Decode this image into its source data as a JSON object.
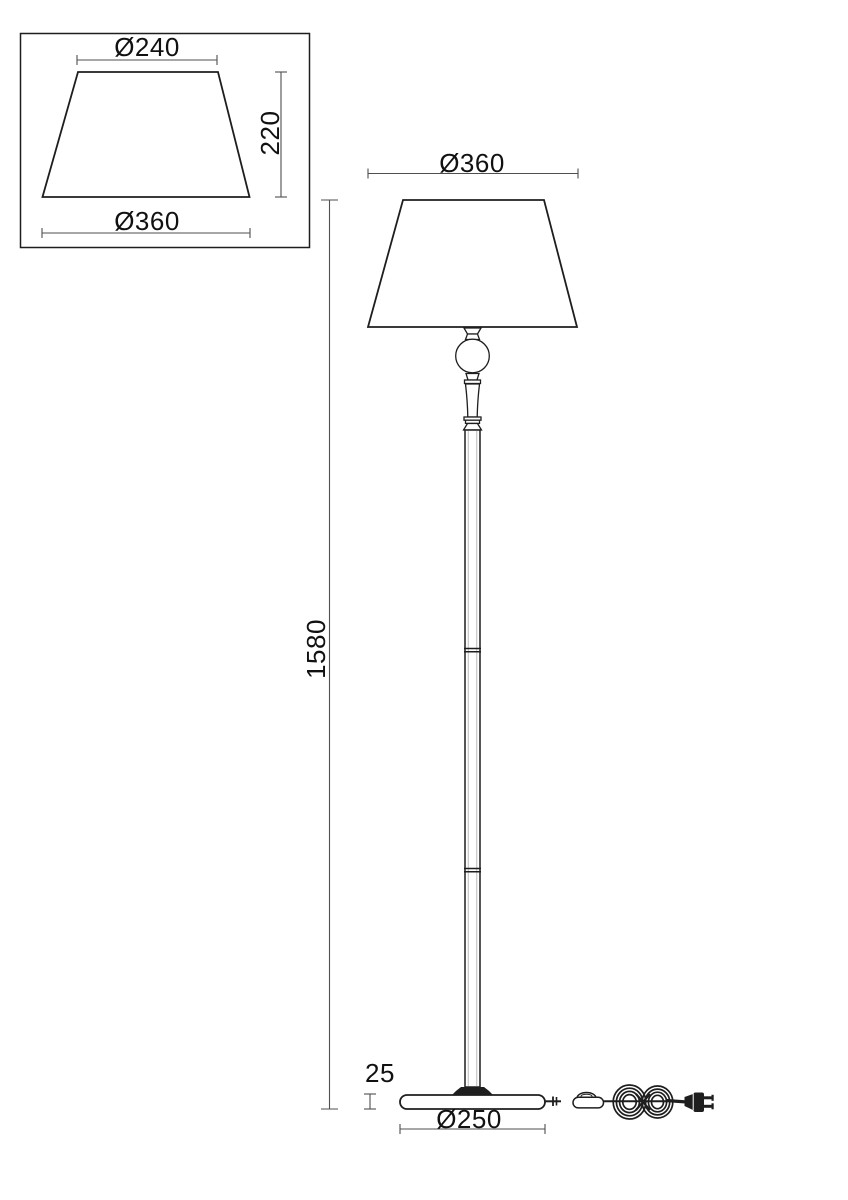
{
  "colors": {
    "background": "#ffffff",
    "line": "#1e1e1e",
    "dimension": "#4f4f4f",
    "text": "#111111"
  },
  "detail_view": {
    "top_diameter_label": "Ø240",
    "height_label": "220",
    "bottom_diameter_label": "Ø360"
  },
  "main_view": {
    "shade_diameter_label": "Ø360",
    "total_height_label": "1580",
    "base_height_label": "25",
    "base_diameter_label": "Ø250"
  }
}
